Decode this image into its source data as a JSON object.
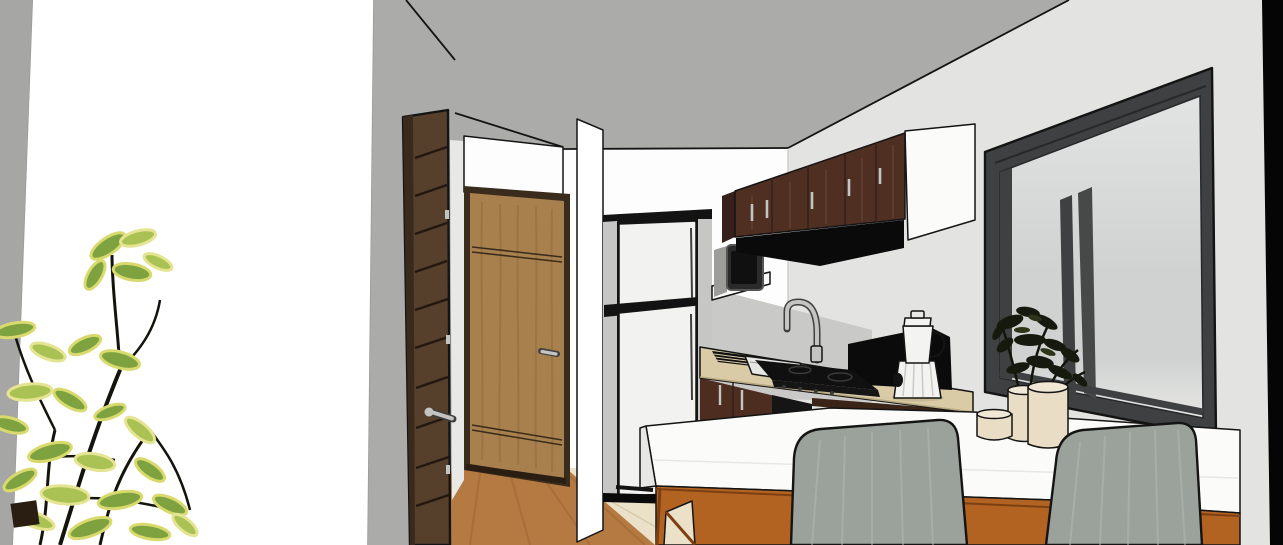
{
  "scene": {
    "description": "SketchUp-style 3D interior render of a small apartment kitchen seen from the living area",
    "contents": "white and gray walls, hallway with two wood doors, refrigerator, dark upper cabinets with hood and microwave, sink and gas cooktop on tan counter, blender, charcoal sliding window with potted plants, white breakfast-bar island on orange wood base, two gray upholstered chairs, variegated houseplant in left foreground",
    "no_visible_text": true
  },
  "objects": [
    {
      "id": "left-wall-plant",
      "label": "variegated houseplant in foreground"
    },
    {
      "id": "entry-door",
      "label": "dark walnut slatted door with chrome lever handle"
    },
    {
      "id": "hallway-door",
      "label": "oak interior door with chrome handle"
    },
    {
      "id": "pillar",
      "label": "white wall pillar"
    },
    {
      "id": "refrigerator",
      "label": "white top-freezer refrigerator with black trim"
    },
    {
      "id": "microwave",
      "label": "wall-mounted microwave on white bracket"
    },
    {
      "id": "upper-cabinets",
      "label": "dark mahogany upper cabinets with white carcass"
    },
    {
      "id": "range-hood",
      "label": "black range hood"
    },
    {
      "id": "sink-faucet",
      "label": "sink with chrome gooseneck faucet and black drainboard"
    },
    {
      "id": "cooktop",
      "label": "black gas cooktop with dark oven below"
    },
    {
      "id": "blender",
      "label": "white blender on tan countertop"
    },
    {
      "id": "window",
      "label": "charcoal aluminum sliding window"
    },
    {
      "id": "window-plants",
      "label": "dark green plants in cream ceramic vases"
    },
    {
      "id": "island",
      "label": "white breakfast-bar island on orange wood base"
    },
    {
      "id": "chairs",
      "label": "two gray upholstered dining chairs"
    },
    {
      "id": "floors",
      "label": "wood laminate hallway floor and beige tile kitchen floor"
    }
  ],
  "palette": {
    "line": "#141414",
    "soft_line": "#9a9a98",
    "white_wall": "#ffffff",
    "left_strip": "#a6a6a4",
    "shell_gray": "#ababa9",
    "right_wall": "#e3e3e1",
    "back_wall": "#fdfdfd",
    "backsplash": "#c9c9c7",
    "jamb_light": "#e8e8e6",
    "dark_door": "#56402c",
    "dark_door_edge": "#3a2a1c",
    "dark_door_line": "#231710",
    "oak_door": "#a8804d",
    "oak_grain": "#8f6a3c",
    "oak_frame": "#3a2c1c",
    "threshold": "#2a1d12",
    "chrome": "#c4c4c2",
    "chrome_dark": "#3f3f3f",
    "floor_wood": "#b57a42",
    "floor_wood_grain": "#9c6732",
    "floor_tile": "#eae1c8",
    "tile_line": "#d6cbae",
    "fridge_trim": "#131313",
    "fridge_side": "#c6c6c4",
    "fridge_door": "#f2f2f0",
    "cab_wood": "#4e2f22",
    "cab_wood_light": "#6b4433",
    "cab_side": "#35201a",
    "cab_white": "#fbfbf9",
    "hood_black": "#0a0a0a",
    "counter_tan": "#d8cba6",
    "counter_edge": "#b7a87f",
    "base_cab": "#4c2d20",
    "under_counter_wood": "#3a2317",
    "appliance_black": "#151515",
    "cooktop_black": "#101010",
    "grate_gray": "#3a3a3a",
    "sink_steel": "#e6e6e4",
    "panel_black": "#0b0b0b",
    "win_frame": "#3e4041",
    "win_frame_light": "#474949",
    "win_frame_dark": "#26282a",
    "glass_top": "#e2e4e4",
    "glass_mid": "#cfd2d1",
    "glass_low": "#e7e7e5",
    "edge_black": "#050505",
    "island_white": "#fbfbf9",
    "island_shade": "#e7e7e5",
    "island_wood": "#b26322",
    "island_wood_dark": "#7c3f12",
    "chair_fabric": "#9ba29b",
    "chair_streak": "#b6bbb4",
    "vase_cream": "#e9ddc6",
    "vase_top": "#f0e7d4",
    "vase_line": "#2a241c",
    "plant_dark": "#161a0e",
    "plant_dark2": "#2c3517",
    "leaf_green": "#7ea23f",
    "leaf_light": "#a9c253",
    "leaf_edge": "#d9da6e",
    "leaf_edge2": "#e4e492",
    "stem": "#14140c",
    "blender_white": "#f3f3f1",
    "blender_pleat": "#c9c9c7",
    "micro_body": "#2a2a2a",
    "micro_side": "#9c9c9a",
    "micro_window": "#101010",
    "micro_frame": "#555555"
  }
}
